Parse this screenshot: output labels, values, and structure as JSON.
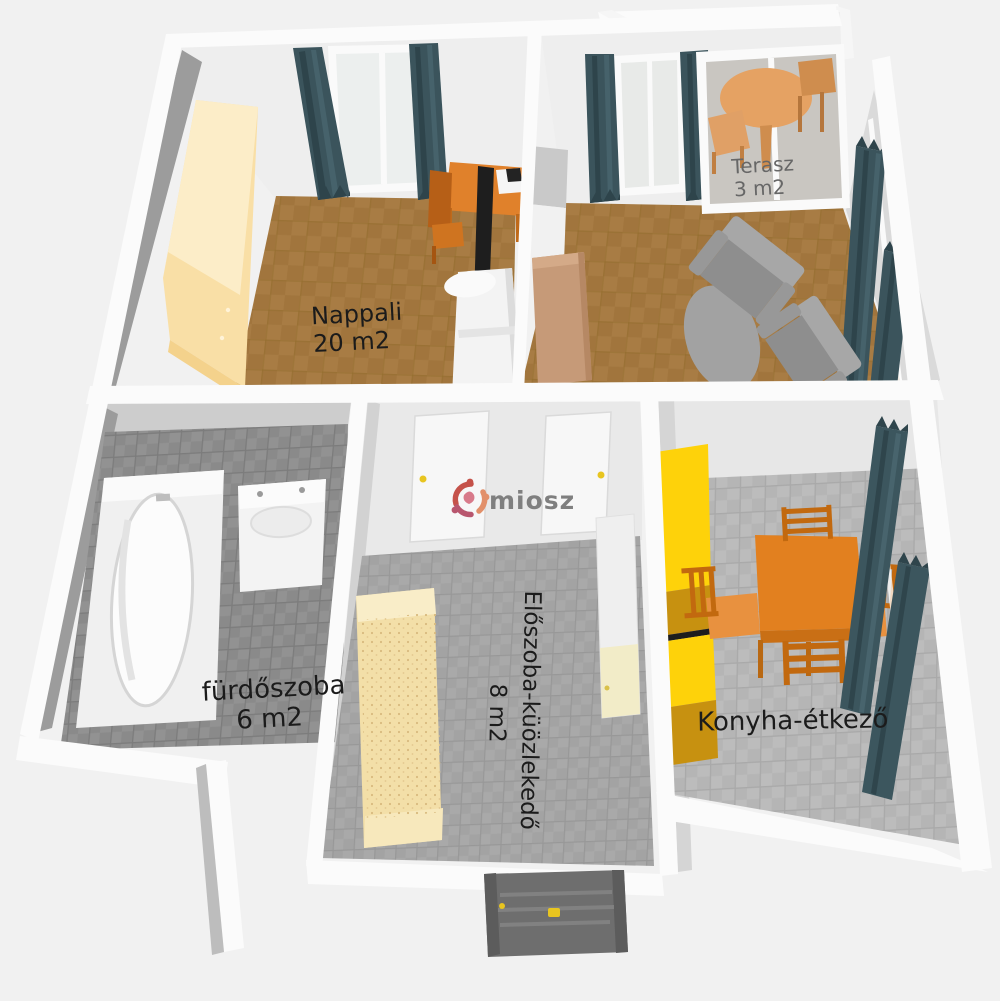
{
  "scene_type": "3D floor plan render",
  "watermark": {
    "brand": "miosz"
  },
  "rooms": [
    {
      "name": "Nappali",
      "area": "20 m2",
      "floor": "brown carpet"
    },
    {
      "name": "Terasz",
      "area": "3 m2",
      "floor": "grey stone"
    },
    {
      "name": "fürdőszoba",
      "area": "6 m2",
      "floor": "dark grey tile"
    },
    {
      "name": "Előszoba-küözlekedő",
      "area": "8 m2",
      "floor": "grey tile"
    },
    {
      "name": "Konyha-étkező",
      "area": "",
      "floor": "light grey tile"
    }
  ],
  "furniture": [
    "wardrobe",
    "curtains",
    "window",
    "desk",
    "desk-chair",
    "tv",
    "laptop",
    "sofa",
    "cabinet",
    "sideboard",
    "armchair",
    "armchair",
    "rug",
    "terrace-table",
    "terrace-chairs",
    "bathtub",
    "sink",
    "hall-doors",
    "hall-cabinet",
    "shelf-unit",
    "entry-door",
    "kitchen-cabinets",
    "dining-table",
    "dining-chairs",
    "benches"
  ],
  "palette": {
    "background": "#f1f1f1",
    "wall_white": "#fbfbfb",
    "wall_face_dark": "#9c9c9c",
    "wall_face_light": "#e9e9e9",
    "carpet": "#a87c44",
    "bath_tile": "#919191",
    "hall_tile": "#a9a9a9",
    "kitchen_tile": "#bcbcbc",
    "curtain": "#3b545c",
    "wardrobe_cream": "#f9dfa6",
    "kitchen_yellow": "#fed20a",
    "kitchen_amber": "#c79110",
    "furniture_orange": "#e2801f",
    "terrace_wood": "#e5a263",
    "sideboard_tan": "#c69a78",
    "armchair_grey": "#a0a0a0",
    "entry_door_grey": "#6e6e6e",
    "handle_yellow": "#e8c520",
    "brand_red": "#c5524a",
    "brand_salmon": "#e2906a",
    "brand_pink": "#b8566e"
  }
}
